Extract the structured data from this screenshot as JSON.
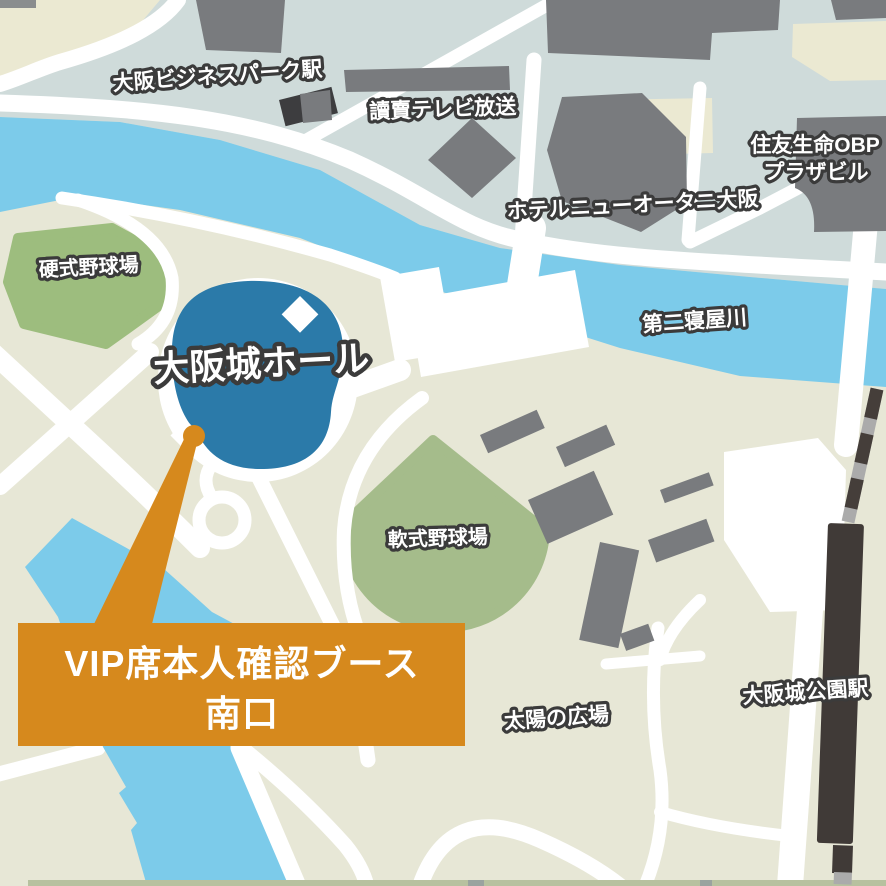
{
  "map": {
    "labels": {
      "obp_station": "大阪ビジネスパーク駅",
      "yomiuri_tv": "讀賣テレビ放送",
      "sumitomo_line1": "住友生命OBP",
      "sumitomo_line2": "プラザビル",
      "hotel": "ホテルニューオータニ大阪",
      "river": "第二寝屋川",
      "hardball_field": "硬式野球場",
      "osaka_jo_hall": "大阪城ホール",
      "softball_field": "軟式野球場",
      "taiyo_plaza": "太陽の広場",
      "castle_park_station": "大阪城公園駅"
    },
    "callout": {
      "line1": "VIP席本人確認ブース",
      "line2": "南口"
    },
    "colors": {
      "park_bg": "#e7e7d6",
      "obp_bg": "#cfdbda",
      "cream": "#ebe9d2",
      "water": "#7ccbea",
      "hall_blue": "#2b7aa9",
      "field_green_1": "#9dbd7e",
      "field_green_2": "#a5bc8b",
      "bank_green": "#d9dfc6",
      "building_gray": "#797b7e",
      "building_dark": "#3d3d3f",
      "road_white": "#ffffff",
      "rail_dark": "#453e3a",
      "rail_gray": "#ababab",
      "station_dark": "#403a37",
      "accent_orange": "#d6891d",
      "label_ink": "#3b3b3b",
      "label_text": "#ffffff",
      "bottom_strip": "#b7c19f"
    }
  }
}
